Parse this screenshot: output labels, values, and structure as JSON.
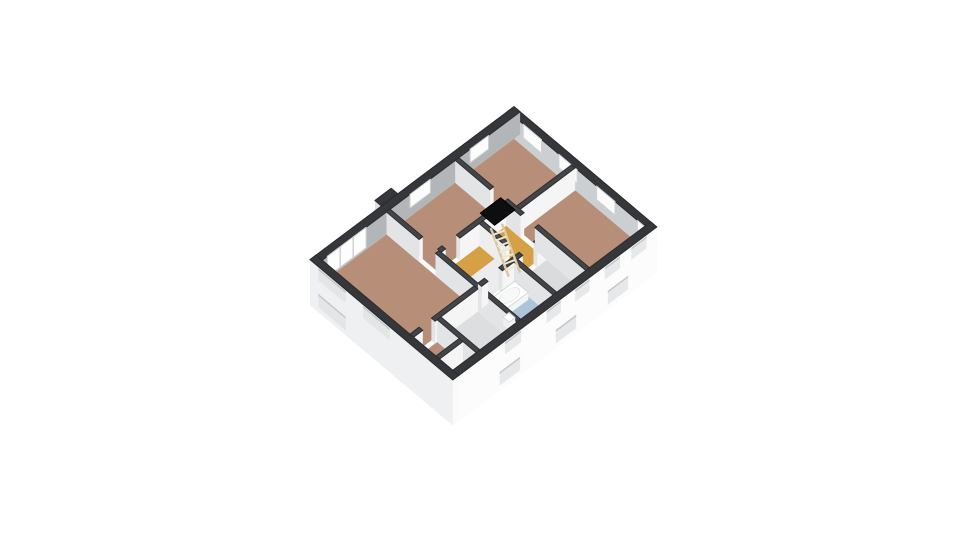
{
  "meta": {
    "title": "3D floor plan – upper storey"
  },
  "canvas": {
    "width": 960,
    "height": 540,
    "background": "#ffffff"
  },
  "scene": {
    "projection": {
      "origin": [
        310,
        282
      ],
      "ex": [
        20.4,
        -15.3
      ],
      "ey": [
        20.4,
        17.2
      ],
      "zk": 16,
      "wallHeight": 1.4
    },
    "palette": {
      "exteriorTop": "#36373b",
      "interiorTop": "#434549",
      "edge": "#2a2b2f",
      "floorBrown": "#b78e78",
      "floorOchre": "#d6a046",
      "floorBlue": "#aec4d8",
      "floorGrey": "#d9dbdc",
      "floorBeige": "#cabb9e",
      "facadeWhite": "#fcfcfd",
      "facadeShade": "#eff0f1"
    },
    "items": [
      {
        "type": "box",
        "name": "wall-ne",
        "rect": [
          9.7,
          0,
          10,
          7
        ],
        "top": "#36373b",
        "sideL": "#cbcfd1",
        "sideR": "#f0f0f0",
        "edge": "#2a2b2f"
      },
      {
        "type": "box",
        "name": "chimney",
        "rect": [
          3.5,
          -0.32,
          4.3,
          0
        ],
        "top": "#36373b",
        "sideL": "#e0e1e2",
        "sideR": "#ececec",
        "edge": "#2a2b2f"
      },
      {
        "type": "box",
        "name": "wall-nw",
        "rect": [
          0,
          0,
          10,
          0.3
        ],
        "top": "#36373b",
        "sideL": "#e9eaeb",
        "sideR": "#b2b6b8",
        "edge": "#2a2b2f"
      },
      {
        "type": "window",
        "name": "window-bedroom-1-nw",
        "plane": "y",
        "at": 0.3,
        "u": [
          0.55,
          2.45
        ],
        "z": [
          0.12,
          1.4
        ],
        "fill": "#fdfdfd",
        "stroke": "#cfd1d3",
        "mullions": [
          1.18,
          1.82
        ]
      },
      {
        "type": "window",
        "name": "window-bedroom-2-nw",
        "plane": "y",
        "at": 0.3,
        "u": [
          4.6,
          5.6
        ],
        "z": [
          0.55,
          1.4
        ],
        "fill": "#fdfdfd",
        "stroke": "#cfd1d3"
      },
      {
        "type": "window",
        "name": "window-bedroom-3-nw",
        "plane": "y",
        "at": 0.3,
        "u": [
          7.55,
          8.45
        ],
        "z": [
          0.55,
          1.4
        ],
        "fill": "#fdfdfd",
        "stroke": "#cfd1d3"
      },
      {
        "type": "window",
        "name": "window-bedroom-3-ne-1",
        "plane": "x",
        "at": 9.7,
        "u": [
          0.75,
          1.65
        ],
        "z": [
          0.55,
          1.4
        ],
        "fill": "#fbfbfb",
        "stroke": "#cfd1d3"
      },
      {
        "type": "window",
        "name": "window-bedroom-3-ne-2",
        "plane": "x",
        "at": 9.7,
        "u": [
          2.5,
          3.4
        ],
        "z": [
          0.55,
          1.4
        ],
        "fill": "#fbfbfb",
        "stroke": "#cfd1d3"
      },
      {
        "type": "window",
        "name": "window-bedroom-4-ne",
        "plane": "x",
        "at": 9.7,
        "u": [
          4.35,
          5.25
        ],
        "z": [
          0.55,
          1.4
        ],
        "fill": "#fbfbfb",
        "stroke": "#cfd1d3"
      },
      {
        "type": "window",
        "name": "window-corner-ne",
        "plane": "x",
        "at": 9.7,
        "u": [
          6.35,
          6.85
        ],
        "z": [
          0.8,
          1.4
        ],
        "fill": "#fbfbfb",
        "stroke": "#cfd1d3"
      },
      {
        "type": "floor",
        "name": "bedroom-1-floor",
        "rect": [
          0.3,
          0.3,
          3.45,
          4.6
        ],
        "fill": "#b78e78"
      },
      {
        "type": "floor",
        "name": "hallway-floor",
        "rect": [
          0.3,
          4.78,
          1.45,
          6.7
        ],
        "fill": "#b78e78"
      },
      {
        "type": "floor",
        "name": "closet-floor",
        "rect": [
          0.3,
          6.05,
          1.45,
          6.7
        ],
        "fill": "#cabb9e"
      },
      {
        "type": "floor",
        "name": "storage-floor",
        "rect": [
          1.63,
          4.78,
          3.45,
          6.7
        ],
        "fill": "#dcdedf"
      },
      {
        "type": "floor",
        "name": "bedroom-2-floor",
        "rect": [
          3.63,
          0.3,
          6.82,
          2.62
        ],
        "fill": "#b78e78"
      },
      {
        "type": "floor",
        "name": "landing-floor",
        "rect": [
          3.63,
          2.8,
          6.82,
          4.6
        ],
        "fill": "#d6a046"
      },
      {
        "type": "floor",
        "name": "stair-void-floor",
        "rect": [
          3.63,
          3.55,
          5.5,
          4.6
        ],
        "fill": "#ececee"
      },
      {
        "type": "floor",
        "name": "bathroom-floor",
        "rect": [
          3.63,
          4.78,
          5.22,
          6.7
        ],
        "fill": "#aec4d8"
      },
      {
        "type": "floor",
        "name": "wc-floor",
        "rect": [
          5.4,
          4.78,
          6.82,
          6.7
        ],
        "fill": "#d9dbdc"
      },
      {
        "type": "floor",
        "name": "bedroom-3-floor",
        "rect": [
          7.0,
          0.3,
          9.7,
          3.12
        ],
        "fill": "#b78e78"
      },
      {
        "type": "floor",
        "name": "bedroom-4-floor",
        "rect": [
          7.0,
          3.3,
          9.7,
          6.7
        ],
        "fill": "#b78e78"
      },
      {
        "type": "box",
        "name": "wall-right-a",
        "rect": [
          6.82,
          0.3,
          7.0,
          2.0
        ],
        "top": "#434549",
        "sideL": "#e3e4e6",
        "sideR": "#f5f5f6",
        "edge": "#2c2d31"
      },
      {
        "type": "box",
        "name": "wall-bedrooms-3-4",
        "rect": [
          7.0,
          3.12,
          9.7,
          3.3
        ],
        "top": "#434549",
        "sideL": "#e3e4e6",
        "sideR": "#f5f5f6",
        "edge": "#2c2d31"
      },
      {
        "type": "box",
        "name": "wall-right-b",
        "rect": [
          6.82,
          2.7,
          7.0,
          3.5
        ],
        "top": "#434549",
        "sideL": "#e3e4e6",
        "sideR": "#f5f5f6",
        "edge": "#2c2d31"
      },
      {
        "type": "box",
        "name": "wall-landing-north",
        "rect": [
          4.55,
          2.62,
          6.82,
          2.8
        ],
        "top": "#434549",
        "sideL": "#e3e4e6",
        "sideR": "#f5f5f6",
        "edge": "#2c2d31"
      },
      {
        "type": "box",
        "name": "wall-bedroom-1-upper",
        "rect": [
          3.45,
          0.3,
          3.63,
          1.9
        ],
        "top": "#434549",
        "sideL": "#e3e4e6",
        "sideR": "#f5f5f6",
        "edge": "#2c2d31"
      },
      {
        "type": "box",
        "name": "wall-stairwell",
        "rect": [
          5.5,
          2.8,
          5.68,
          4.1
        ],
        "top": "#4a4b4e",
        "sideL": "#eeeeef",
        "sideR": "#f7f7f8",
        "edge": "#2c2d31"
      },
      {
        "type": "box",
        "name": "wall-wc-north",
        "rect": [
          6.35,
          4.6,
          6.82,
          4.78
        ],
        "top": "#434549",
        "sideL": "#e3e4e6",
        "sideR": "#f5f5f6",
        "edge": "#2c2d31"
      },
      {
        "type": "box",
        "name": "wall-right-c",
        "rect": [
          6.82,
          4.2,
          7.0,
          6.7
        ],
        "top": "#434549",
        "sideL": "#e3e4e6",
        "sideR": "#f5f5f6",
        "edge": "#2c2d31"
      },
      {
        "type": "box",
        "name": "wall-landing-north-stub",
        "rect": [
          3.63,
          2.62,
          3.85,
          2.8
        ],
        "top": "#434549",
        "sideL": "#e3e4e6",
        "sideR": "#f5f5f6",
        "edge": "#2c2d31"
      },
      {
        "type": "box",
        "name": "wall-bath-north",
        "rect": [
          4.65,
          4.6,
          5.65,
          4.78
        ],
        "top": "#434549",
        "sideL": "#e3e4e6",
        "sideR": "#f5f5f6",
        "edge": "#2c2d31"
      },
      {
        "type": "box",
        "name": "wall-bath-wc",
        "rect": [
          5.22,
          4.78,
          5.4,
          6.7
        ],
        "top": "#434549",
        "sideL": "#e3e4e6",
        "sideR": "#f5f5f6",
        "edge": "#2c2d31"
      },
      {
        "type": "box",
        "name": "bathtub-deck",
        "rect": [
          3.95,
          4.92,
          5.12,
          5.58
        ],
        "h": 0.45,
        "top": "#ffffff",
        "sideL": "#eef0f0",
        "sideR": "#f4f6f6",
        "edge": "#d5d7d9"
      },
      {
        "type": "ellipse",
        "name": "bathtub-basin",
        "c": [
          4.535,
          5.25
        ],
        "r": [
          0.45,
          0.23
        ],
        "z": 0.46,
        "fill": "#f7f8f8",
        "stroke": "#c5c8ca"
      },
      {
        "type": "box",
        "name": "wall-bedroom-1-lower",
        "rect": [
          3.45,
          2.7,
          3.63,
          6.7
        ],
        "top": "#434549",
        "sideL": "#e3e4e6",
        "sideR": "#f5f5f6",
        "edge": "#2c2d31"
      },
      {
        "type": "box",
        "name": "wall-bath-north-stub",
        "rect": [
          3.63,
          4.6,
          3.95,
          4.78
        ],
        "top": "#434549",
        "sideL": "#e3e4e6",
        "sideR": "#f5f5f6",
        "edge": "#2c2d31"
      },
      {
        "type": "box",
        "name": "washbasin",
        "rect": [
          3.68,
          5.78,
          3.98,
          6.08
        ],
        "h": 0.5,
        "top": "#ffffff",
        "sideL": "#eef0f0",
        "sideR": "#f4f6f6",
        "edge": "#d5d7d9"
      },
      {
        "type": "box",
        "name": "wall-bedroom-1-south-b",
        "rect": [
          1.35,
          4.6,
          3.45,
          4.78
        ],
        "top": "#434549",
        "sideL": "#e3e4e6",
        "sideR": "#f5f5f6",
        "edge": "#2c2d31"
      },
      {
        "type": "box",
        "name": "wall-bedroom-1-south-a",
        "rect": [
          0.3,
          4.6,
          0.75,
          4.78
        ],
        "top": "#434549",
        "sideL": "#e3e4e6",
        "sideR": "#f5f5f6",
        "edge": "#2c2d31"
      },
      {
        "type": "box",
        "name": "wall-hall-storage",
        "rect": [
          1.45,
          4.78,
          1.63,
          6.7
        ],
        "top": "#434549",
        "sideL": "#e3e4e6",
        "sideR": "#f5f5f6",
        "edge": "#2c2d31"
      },
      {
        "type": "box",
        "name": "wall-closet",
        "rect": [
          0.3,
          5.87,
          1.45,
          6.05
        ],
        "top": "#434549",
        "sideL": "#e3e4e6",
        "sideR": "#f5f5f6",
        "edge": "#2c2d31"
      },
      {
        "type": "ladder",
        "name": "loft-ladder",
        "top": [
          5.85,
          3.3,
          1.4
        ],
        "bottom": [
          5.55,
          4.45,
          0
        ],
        "rungs": 7,
        "halfWidth": 6,
        "rail": "#d9c9a2",
        "rung": "#efe6cf"
      },
      {
        "type": "floor",
        "name": "loft-hatch",
        "rect": [
          5.8,
          2.55,
          6.8,
          3.25
        ],
        "z": 1.5,
        "fill": "#0e0e10",
        "stroke": "#000000"
      },
      {
        "type": "box",
        "name": "wall-se",
        "rect": [
          0,
          6.7,
          10,
          7
        ],
        "skirt": -1.45,
        "top": "#36373b",
        "sideL": "#f0f1f2",
        "sideR": "#fcfcfd",
        "edge": "#2a2b2f"
      },
      {
        "type": "box",
        "name": "wall-sw",
        "rect": [
          0,
          0,
          0.3,
          7
        ],
        "skirt": -1.45,
        "top": "#36373b",
        "sideL": "#eff0f1",
        "sideR": "#fafafa",
        "edge": "#2a2b2f"
      },
      {
        "type": "recess",
        "name": "facade-window-se-up-1",
        "plane": "y",
        "at": 7,
        "u": [
          2.55,
          3.35
        ],
        "z": [
          0.55,
          1.3
        ],
        "fill": "#e7e8ea",
        "sliver": "#c6c8ca"
      },
      {
        "type": "recess",
        "name": "facade-window-se-up-2",
        "plane": "y",
        "at": 7,
        "u": [
          4.6,
          5.3
        ],
        "z": [
          0.55,
          1.3
        ],
        "fill": "#e7e8ea",
        "sliver": "#c6c8ca"
      },
      {
        "type": "recess",
        "name": "facade-window-se-up-3",
        "plane": "y",
        "at": 7,
        "u": [
          6.0,
          6.7
        ],
        "z": [
          0.55,
          1.3
        ],
        "fill": "#e7e8ea",
        "sliver": "#c6c8ca"
      },
      {
        "type": "recess",
        "name": "facade-window-se-up-4",
        "plane": "y",
        "at": 7,
        "u": [
          7.45,
          8.2
        ],
        "z": [
          0.55,
          1.3
        ],
        "fill": "#e7e8ea",
        "sliver": "#c6c8ca"
      },
      {
        "type": "recess",
        "name": "facade-window-se-up-5",
        "plane": "y",
        "at": 7,
        "u": [
          8.75,
          9.5
        ],
        "z": [
          0.55,
          1.3
        ],
        "fill": "#e7e8ea",
        "sliver": "#c6c8ca"
      },
      {
        "type": "recess",
        "name": "facade-window-se-low-1",
        "plane": "y",
        "at": 7,
        "u": [
          2.3,
          3.3
        ],
        "z": [
          -1.15,
          -0.3
        ],
        "fill": "#e7e8ea",
        "sliver": "#c6c8ca"
      },
      {
        "type": "recess",
        "name": "facade-window-se-low-2",
        "plane": "y",
        "at": 7,
        "u": [
          5.05,
          6.05
        ],
        "z": [
          -1.15,
          -0.3
        ],
        "fill": "#e7e8ea",
        "sliver": "#c6c8ca"
      },
      {
        "type": "recess",
        "name": "facade-window-se-low-3",
        "plane": "y",
        "at": 7,
        "u": [
          7.6,
          8.6
        ],
        "z": [
          -1.15,
          -0.3
        ],
        "fill": "#e7e8ea",
        "sliver": "#c6c8ca"
      },
      {
        "type": "recess",
        "name": "facade-window-sw-up-1",
        "plane": "x",
        "at": 0,
        "u": [
          0.4,
          1.75
        ],
        "z": [
          0.55,
          1.3
        ],
        "fill": "#e4e5e7",
        "sliver": "#c6c8ca"
      },
      {
        "type": "recess",
        "name": "facade-window-sw-up-2",
        "plane": "x",
        "at": 0,
        "u": [
          2.6,
          3.9
        ],
        "z": [
          0.55,
          1.3
        ],
        "fill": "#e4e5e7",
        "sliver": "#c6c8ca"
      },
      {
        "type": "recess",
        "name": "facade-window-sw-low-1",
        "plane": "x",
        "at": 0,
        "u": [
          0.4,
          1.75
        ],
        "z": [
          -1.15,
          -0.3
        ],
        "fill": "#e4e5e7",
        "sliver": "#c6c8ca"
      }
    ]
  }
}
